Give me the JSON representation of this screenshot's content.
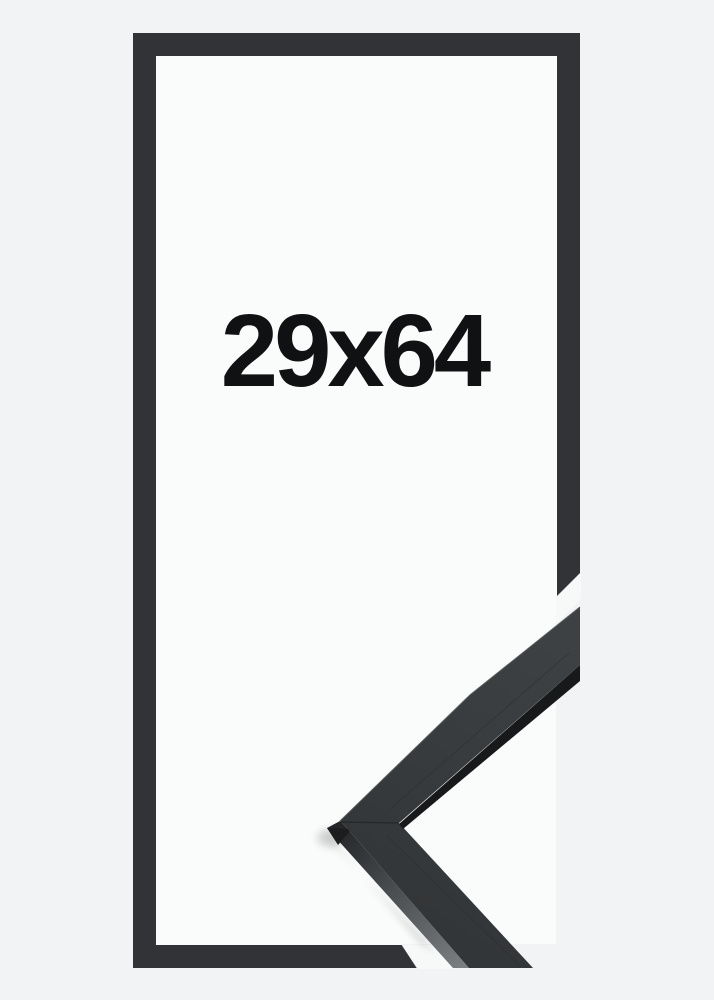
{
  "frame": {
    "size_label": "29x64",
    "colors": {
      "background": "#f2f3f4",
      "interior": "#fafbfb",
      "frame_band": "#313336",
      "gap_white": "#f7f8f8",
      "moulding_top_dark": "#323537",
      "moulding_top_light": "#3e4143",
      "moulding_front": "#17191b",
      "moulding_side_dark": "#232527",
      "moulding_side_light": "#7a7e81",
      "moulding_edge_highlight": "#4a4d4f",
      "moulding_groove": "#2b2e30",
      "seam": "#26282a",
      "end_face": "#1b1d1f",
      "shadow": "#000000",
      "label_text": "#101112"
    }
  }
}
